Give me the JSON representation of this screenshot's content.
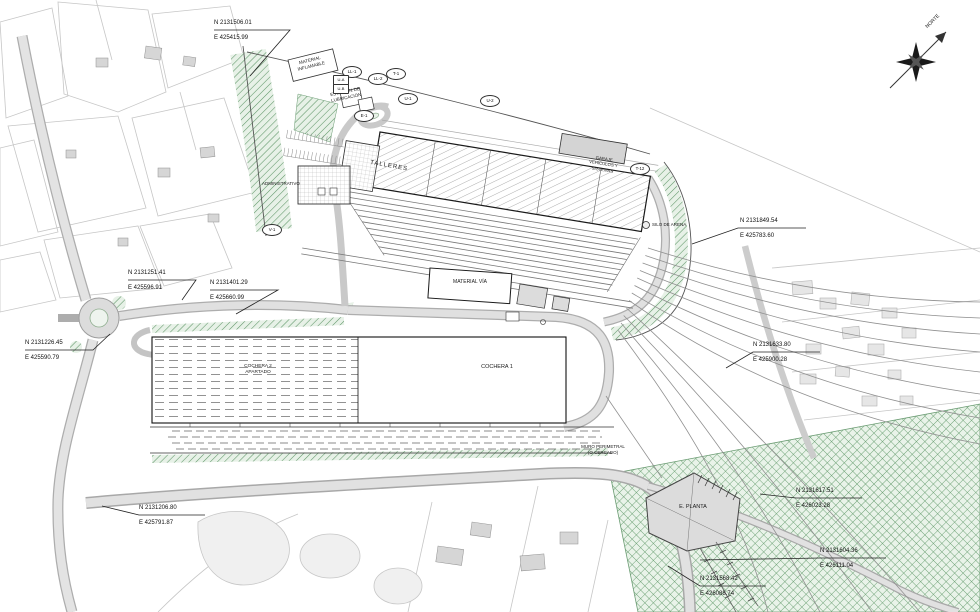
{
  "meta": {
    "drawing_type": "railway depot site plan",
    "colors": {
      "green_hatch": "#5f9668",
      "green_fill": "#e7f1e7",
      "road_fill": "#e1e1e1",
      "ink": "#1a1a1a"
    }
  },
  "compass": {
    "label": "NORTE"
  },
  "callouts": [
    {
      "n": "N 2131506.01",
      "e": "E 425415.99"
    },
    {
      "n": "N 2131849.54",
      "e": "E 425783.60"
    },
    {
      "n": "N 2131251.41",
      "e": "E 425596.91"
    },
    {
      "n": "N 2131401.29",
      "e": "E 425660.99"
    },
    {
      "n": "N 2131226.45",
      "e": "E 425590.79"
    },
    {
      "n": "N 2131633.80",
      "e": "E 425900.28"
    },
    {
      "n": "N 2131617.51",
      "e": "E 426023.28"
    },
    {
      "n": "N 2131604.36",
      "e": "E 426111.04"
    },
    {
      "n": "N 2131568.42",
      "e": "E 426088.74"
    },
    {
      "n": "N 2131206.80",
      "e": "E 425791.87"
    }
  ],
  "buildings": {
    "material_inflamable": "MATERIAL\nINFLAMABLE",
    "lubricacion": "ESTACIÓN DE\nLUBRICACIÓN",
    "administrativo": "ADMINISTRATIVO",
    "talleres": "TALLERES",
    "garaje": "GARAJE\nVEHÍCULOS Y\nSISTEMAS",
    "silo": "SILO DE ARENA",
    "material_via": "MATERIAL VÍA",
    "cochera1": "COCHERA 1",
    "cochera2": "COCHERA 2\nAPARTADO",
    "muro": "MURO PERIMETRAL\n(O CERCADO)",
    "planta": "E. PLANTA"
  },
  "track_labels": [
    {
      "label": "LL-1"
    },
    {
      "label": "LL-2"
    },
    {
      "label": "T-1"
    },
    {
      "label": "U-1"
    },
    {
      "label": "U-2"
    },
    {
      "label": "T-12"
    },
    {
      "label": "E-1"
    },
    {
      "label": "V-1"
    },
    {
      "label": "U-A"
    },
    {
      "label": "U-B"
    }
  ]
}
